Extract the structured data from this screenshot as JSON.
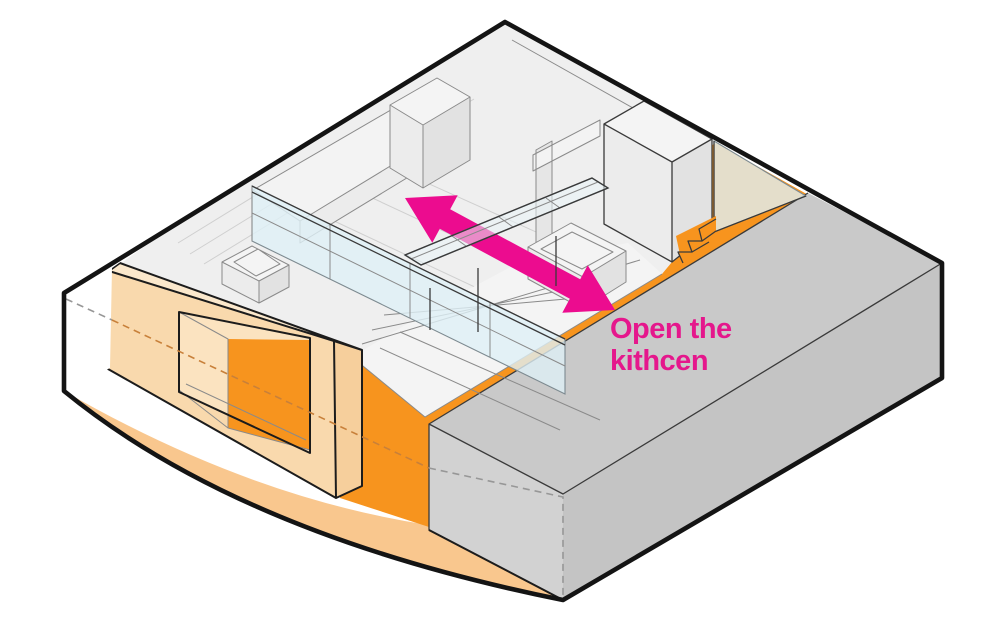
{
  "title": "Open the kitchen - axonometric concept diagram",
  "annotation": {
    "line1": "Open the",
    "line2": "kithcen",
    "color": "#e5178c"
  },
  "arrow": {
    "type": "double-headed",
    "color": "#ec0c8f"
  },
  "colors": {
    "background": "#ffffff",
    "outline": "#141414",
    "floor_orange": "#f7941e",
    "floor_edge_peach": "#f9c78e",
    "peach_wall_top": "#fbe8cc",
    "peach_wall_front": "#f9d9ad",
    "peach_wall_end": "#f6cf9c",
    "peach_wall_sill": "#fbe3c0",
    "slab_top": "#c9c9c9",
    "slab_left_face": "#d2d2d2",
    "slab_right_face": "#c4c4c4",
    "room_base_gray": "#efefef",
    "wall_gray": "#e6e6e6",
    "counter_white": "#f3f3f3",
    "box_face_light": "#f4f4f4",
    "box_face_mid": "#ececec",
    "box_face_dark": "#e2e2e2",
    "glass_blue": "#dff0f6",
    "glass_corner_blue": "#eaf6fa",
    "steps_orange": "#f7941e"
  },
  "parts": [
    "curved-outer-boundary",
    "orange-kitchen-floor",
    "peach-pass-through-wall",
    "window-opening",
    "glass-partition-wall",
    "sliding-glass-panel",
    "kitchen-counters",
    "tall-cabinet",
    "sink-unit",
    "bench-platform",
    "steps",
    "neighbor-slab-volume",
    "glass-corner",
    "double-arrow"
  ]
}
